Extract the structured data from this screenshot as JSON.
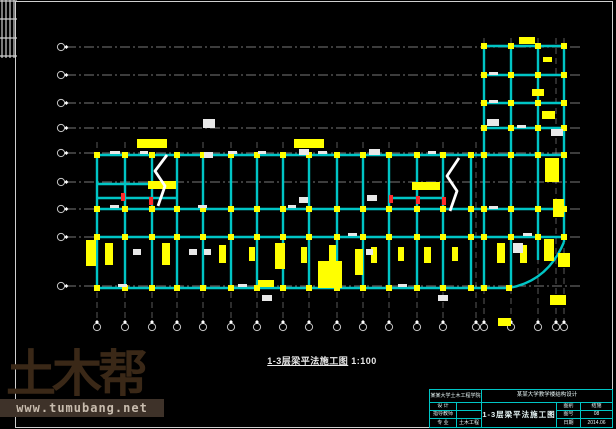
{
  "caption": {
    "text": "1-3层梁平法施工图",
    "scale": "1:100"
  },
  "watermark": {
    "logo": "土木帮",
    "url": "www.tumubang.net",
    "logo_color": "#3A2817",
    "strip_bg": "#3E3229",
    "strip_text_color": "#C8BCAE"
  },
  "title_block": {
    "top_left": "某某大学土木工程学院",
    "top_right": "某某大学教学楼结构设计",
    "left_rows": [
      {
        "label": "设 计",
        "value": ""
      },
      {
        "label": "指导教师",
        "value": ""
      },
      {
        "label": "专 业",
        "value": "土木工程"
      }
    ],
    "drawing_title": "1-3层梁平法施工图",
    "right_rows": [
      {
        "label": "图别",
        "value": "结施"
      },
      {
        "label": "图号",
        "value": "08"
      },
      {
        "label": "日期",
        "value": "2014.06"
      }
    ]
  },
  "colors": {
    "background": "#000000",
    "beam": "#00C5C5",
    "column": "#FFFF00",
    "gridline": "#C8C8C8",
    "frame": "#CFCFCF",
    "annotation_white": "#E8E8E8",
    "annotation_red": "#FF2A2A",
    "titleblock_border": "#00C5C5"
  },
  "drawing": {
    "frame": {
      "x": 15,
      "y": 1,
      "w": 597,
      "h": 426
    },
    "hatch_block": {
      "x": 0,
      "y": 0,
      "w": 17,
      "h": 58,
      "v_lines": [
        2,
        6,
        10,
        14
      ],
      "h_lines": [
        1,
        19,
        38,
        56
      ]
    },
    "grid_h_y": [
      47,
      75,
      103,
      128,
      153,
      182,
      209,
      237,
      286
    ],
    "grid_h_x1": 66,
    "grid_h_x2": 580,
    "bubble_left_x": 61,
    "grid_v": [
      [
        97,
        142
      ],
      [
        125,
        142
      ],
      [
        152,
        142
      ],
      [
        177,
        142
      ],
      [
        203,
        142
      ],
      [
        231,
        142
      ],
      [
        257,
        142
      ],
      [
        283,
        142
      ],
      [
        309,
        142
      ],
      [
        337,
        142
      ],
      [
        363,
        142
      ],
      [
        389,
        142
      ],
      [
        417,
        142
      ],
      [
        443,
        142
      ],
      [
        476,
        142
      ],
      [
        484,
        38
      ],
      [
        511,
        38
      ],
      [
        538,
        38
      ],
      [
        556,
        38
      ],
      [
        564,
        38
      ]
    ],
    "grid_v_ybottom": 322,
    "bubble_bottom_y": 327,
    "bubble_r": 3.6,
    "beams_h": [
      [
        46,
        484,
        564
      ],
      [
        75,
        484,
        564
      ],
      [
        103,
        484,
        564
      ],
      [
        128,
        484,
        564
      ],
      [
        155,
        97,
        564
      ],
      [
        184,
        97,
        152
      ],
      [
        198,
        97,
        177
      ],
      [
        198,
        389,
        443
      ],
      [
        209,
        97,
        564
      ],
      [
        237,
        97,
        564
      ],
      [
        288,
        97,
        509
      ]
    ],
    "beams_v": [
      [
        97,
        155,
        288
      ],
      [
        125,
        155,
        288
      ],
      [
        152,
        155,
        288
      ],
      [
        177,
        155,
        288
      ],
      [
        203,
        155,
        288
      ],
      [
        231,
        155,
        288
      ],
      [
        257,
        155,
        288
      ],
      [
        283,
        155,
        288
      ],
      [
        309,
        155,
        288
      ],
      [
        337,
        155,
        288
      ],
      [
        363,
        155,
        288
      ],
      [
        389,
        155,
        288
      ],
      [
        417,
        155,
        288
      ],
      [
        443,
        155,
        288
      ],
      [
        471,
        155,
        288
      ],
      [
        484,
        46,
        288
      ],
      [
        511,
        46,
        288
      ],
      [
        538,
        46,
        260
      ],
      [
        564,
        46,
        242
      ]
    ],
    "arc": "M509,288 Q548,281 564,242",
    "column_rows": [
      [
        46,
        [
          484,
          511,
          538,
          564
        ]
      ],
      [
        75,
        [
          484,
          511,
          538,
          564
        ]
      ],
      [
        103,
        [
          484,
          511,
          538,
          564
        ]
      ],
      [
        128,
        [
          484,
          511,
          538,
          564
        ]
      ],
      [
        155,
        [
          97,
          125,
          152,
          177,
          203,
          231,
          257,
          283,
          309,
          337,
          363,
          389,
          417,
          443,
          471,
          484,
          511,
          538,
          564
        ]
      ],
      [
        209,
        [
          97,
          125,
          152,
          177,
          203,
          231,
          257,
          283,
          309,
          337,
          363,
          389,
          417,
          443,
          471,
          484,
          511,
          538,
          564
        ]
      ],
      [
        237,
        [
          97,
          125,
          152,
          177,
          203,
          231,
          257,
          283,
          309,
          337,
          363,
          389,
          417,
          443,
          471,
          484,
          511,
          538,
          564
        ]
      ],
      [
        288,
        [
          97,
          125,
          152,
          177,
          203,
          231,
          257,
          283,
          309,
          337,
          363,
          389,
          417,
          443,
          471,
          484,
          509
        ]
      ]
    ],
    "yellow_annotations": [
      [
        137,
        139,
        30,
        9
      ],
      [
        294,
        139,
        30,
        9
      ],
      [
        519,
        37,
        16,
        7
      ],
      [
        543,
        57,
        9,
        5
      ],
      [
        148,
        181,
        28,
        8
      ],
      [
        412,
        182,
        28,
        8
      ],
      [
        86,
        240,
        10,
        26
      ],
      [
        105,
        243,
        8,
        22
      ],
      [
        162,
        243,
        8,
        22
      ],
      [
        219,
        245,
        7,
        18
      ],
      [
        249,
        247,
        6,
        14
      ],
      [
        275,
        243,
        10,
        26
      ],
      [
        301,
        247,
        6,
        16
      ],
      [
        329,
        245,
        7,
        18
      ],
      [
        318,
        261,
        24,
        27
      ],
      [
        355,
        249,
        8,
        26
      ],
      [
        371,
        247,
        6,
        16
      ],
      [
        398,
        247,
        6,
        14
      ],
      [
        424,
        247,
        7,
        16
      ],
      [
        452,
        247,
        6,
        14
      ],
      [
        497,
        243,
        8,
        20
      ],
      [
        520,
        245,
        7,
        18
      ],
      [
        544,
        239,
        10,
        22
      ],
      [
        532,
        89,
        12,
        7
      ],
      [
        542,
        111,
        13,
        8
      ],
      [
        545,
        158,
        14,
        24
      ],
      [
        553,
        199,
        11,
        18
      ],
      [
        558,
        253,
        12,
        14
      ],
      [
        550,
        295,
        16,
        10
      ],
      [
        498,
        318,
        13,
        8
      ],
      [
        258,
        280,
        16,
        7
      ]
    ],
    "white_annotations": [
      [
        203,
        119,
        12,
        9
      ],
      [
        204,
        152,
        9,
        6
      ],
      [
        299,
        149,
        10,
        6
      ],
      [
        369,
        149,
        11,
        6
      ],
      [
        299,
        197,
        9,
        6
      ],
      [
        367,
        195,
        10,
        6
      ],
      [
        487,
        119,
        12,
        7
      ],
      [
        551,
        129,
        12,
        7
      ],
      [
        133,
        249,
        8,
        6
      ],
      [
        189,
        249,
        8,
        6
      ],
      [
        204,
        249,
        7,
        6
      ],
      [
        262,
        295,
        10,
        6
      ],
      [
        366,
        249,
        7,
        6
      ],
      [
        438,
        295,
        10,
        6
      ],
      [
        513,
        243,
        10,
        10
      ],
      [
        110,
        151,
        10,
        3
      ],
      [
        140,
        151,
        8,
        3
      ],
      [
        228,
        151,
        9,
        3
      ],
      [
        258,
        151,
        8,
        3
      ],
      [
        318,
        151,
        9,
        3
      ],
      [
        428,
        151,
        8,
        3
      ],
      [
        110,
        205,
        9,
        3
      ],
      [
        198,
        205,
        9,
        3
      ],
      [
        288,
        205,
        8,
        3
      ],
      [
        348,
        233,
        9,
        3
      ],
      [
        118,
        284,
        9,
        3
      ],
      [
        238,
        284,
        9,
        3
      ],
      [
        398,
        284,
        9,
        3
      ],
      [
        489,
        72,
        9,
        3
      ],
      [
        489,
        100,
        9,
        3
      ],
      [
        517,
        125,
        9,
        3
      ],
      [
        489,
        206,
        9,
        3
      ],
      [
        523,
        233,
        9,
        3
      ]
    ],
    "red_annotations": [
      [
        121,
        193,
        4,
        8
      ],
      [
        149,
        197,
        4,
        8
      ],
      [
        389,
        195,
        4,
        8
      ],
      [
        416,
        196,
        4,
        8
      ],
      [
        442,
        197,
        4,
        8
      ]
    ],
    "break_lines": [
      "M158,206 L165,186 L155,171 L167,155",
      "M450,211 L457,191 L447,176 L459,158"
    ]
  }
}
